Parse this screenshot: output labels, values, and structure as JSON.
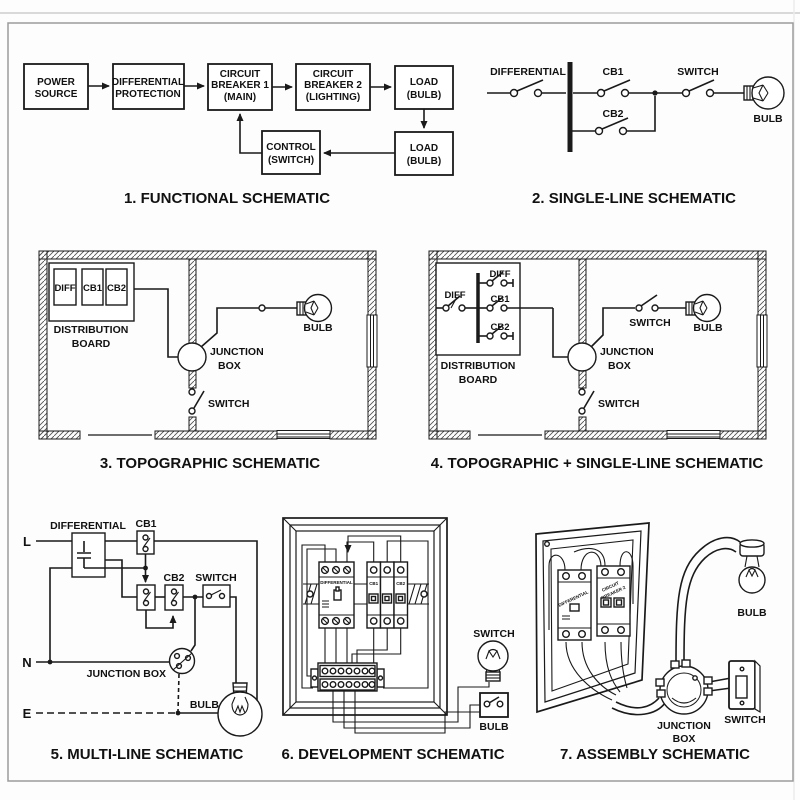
{
  "page": {
    "background": "#fdfdfd",
    "line_color": "#1a1a1a",
    "frame_color": "#9b9b9b",
    "top_rule_color": "#d9d9d9"
  },
  "sections": {
    "s1": {
      "caption": "1. FUNCTIONAL SCHEMATIC",
      "labels": {
        "power": [
          "POWER",
          "SOURCE"
        ],
        "diffprot": [
          "DIFFERENTIAL",
          "PROTECTION"
        ],
        "cb1": [
          "CIRCUIT",
          "BREAKER 1",
          "(MAIN)"
        ],
        "cb2": [
          "CIRCUIT",
          "BREAKER 2",
          "(LIGHTING)"
        ],
        "load1": [
          "LOAD",
          "(BULB)"
        ],
        "control": [
          "CONTROL",
          "(SWITCH)"
        ],
        "load2": [
          "LOAD",
          "(BULB)"
        ]
      }
    },
    "s2": {
      "caption": "2. SINGLE-LINE SCHEMATIC",
      "labels": {
        "differential": "DIFFERENTIAL",
        "cb1": "CB1",
        "cb2": "CB2",
        "switch": "SWITCH",
        "bulb": "BULB"
      }
    },
    "s3": {
      "caption": "3. TOPOGRAPHIC SCHEMATIC",
      "labels": {
        "diff": "DIFF",
        "cb1": "CB1",
        "cb2": "CB2",
        "board": [
          "DISTRIBUTION",
          "BOARD"
        ],
        "junction": [
          "JUNCTION",
          "BOX"
        ],
        "bulb": "BULB",
        "switch": "SWITCH"
      }
    },
    "s4": {
      "caption": "4. TOPOGRAPHIC + SINGLE-LINE SCHEMATIC",
      "labels": {
        "diff_feed": "DIFF",
        "bus_diff": "DIFF",
        "bus_cb1": "CB1",
        "bus_cb2": "CB2",
        "board": [
          "DISTRIBUTION",
          "BOARD"
        ],
        "junction": [
          "JUNCTION",
          "BOX"
        ],
        "switch_room": "SWITCH",
        "bulb": "BULB",
        "switch_below": "SWITCH"
      }
    },
    "s5": {
      "caption": "5. MULTI-LINE SCHEMATIC",
      "labels": {
        "l": "L",
        "n": "N",
        "e": "E",
        "differential": "DIFFERENTIAL",
        "cb1": "CB1",
        "cb2": "CB2",
        "switch": "SWITCH",
        "junction": "JUNCTION BOX",
        "bulb": "BULB"
      }
    },
    "s6": {
      "caption": "6. DEVELOPMENT SCHEMATIC",
      "labels": {
        "differential": "DIFFERENTIAL",
        "cb1": "CB1",
        "cb2": "CB2",
        "switch": "SWITCH",
        "bulb": "BULB"
      }
    },
    "s7": {
      "caption": "7. ASSEMBLY SCHEMATIC",
      "labels": {
        "differential": "DIFFERENTIAL",
        "breaker": [
          "CIRCUIT",
          "BREAKER 2"
        ],
        "bulb": "BULB",
        "junction": [
          "JUNCTION",
          "BOX"
        ],
        "switch": "SWITCH"
      }
    }
  }
}
